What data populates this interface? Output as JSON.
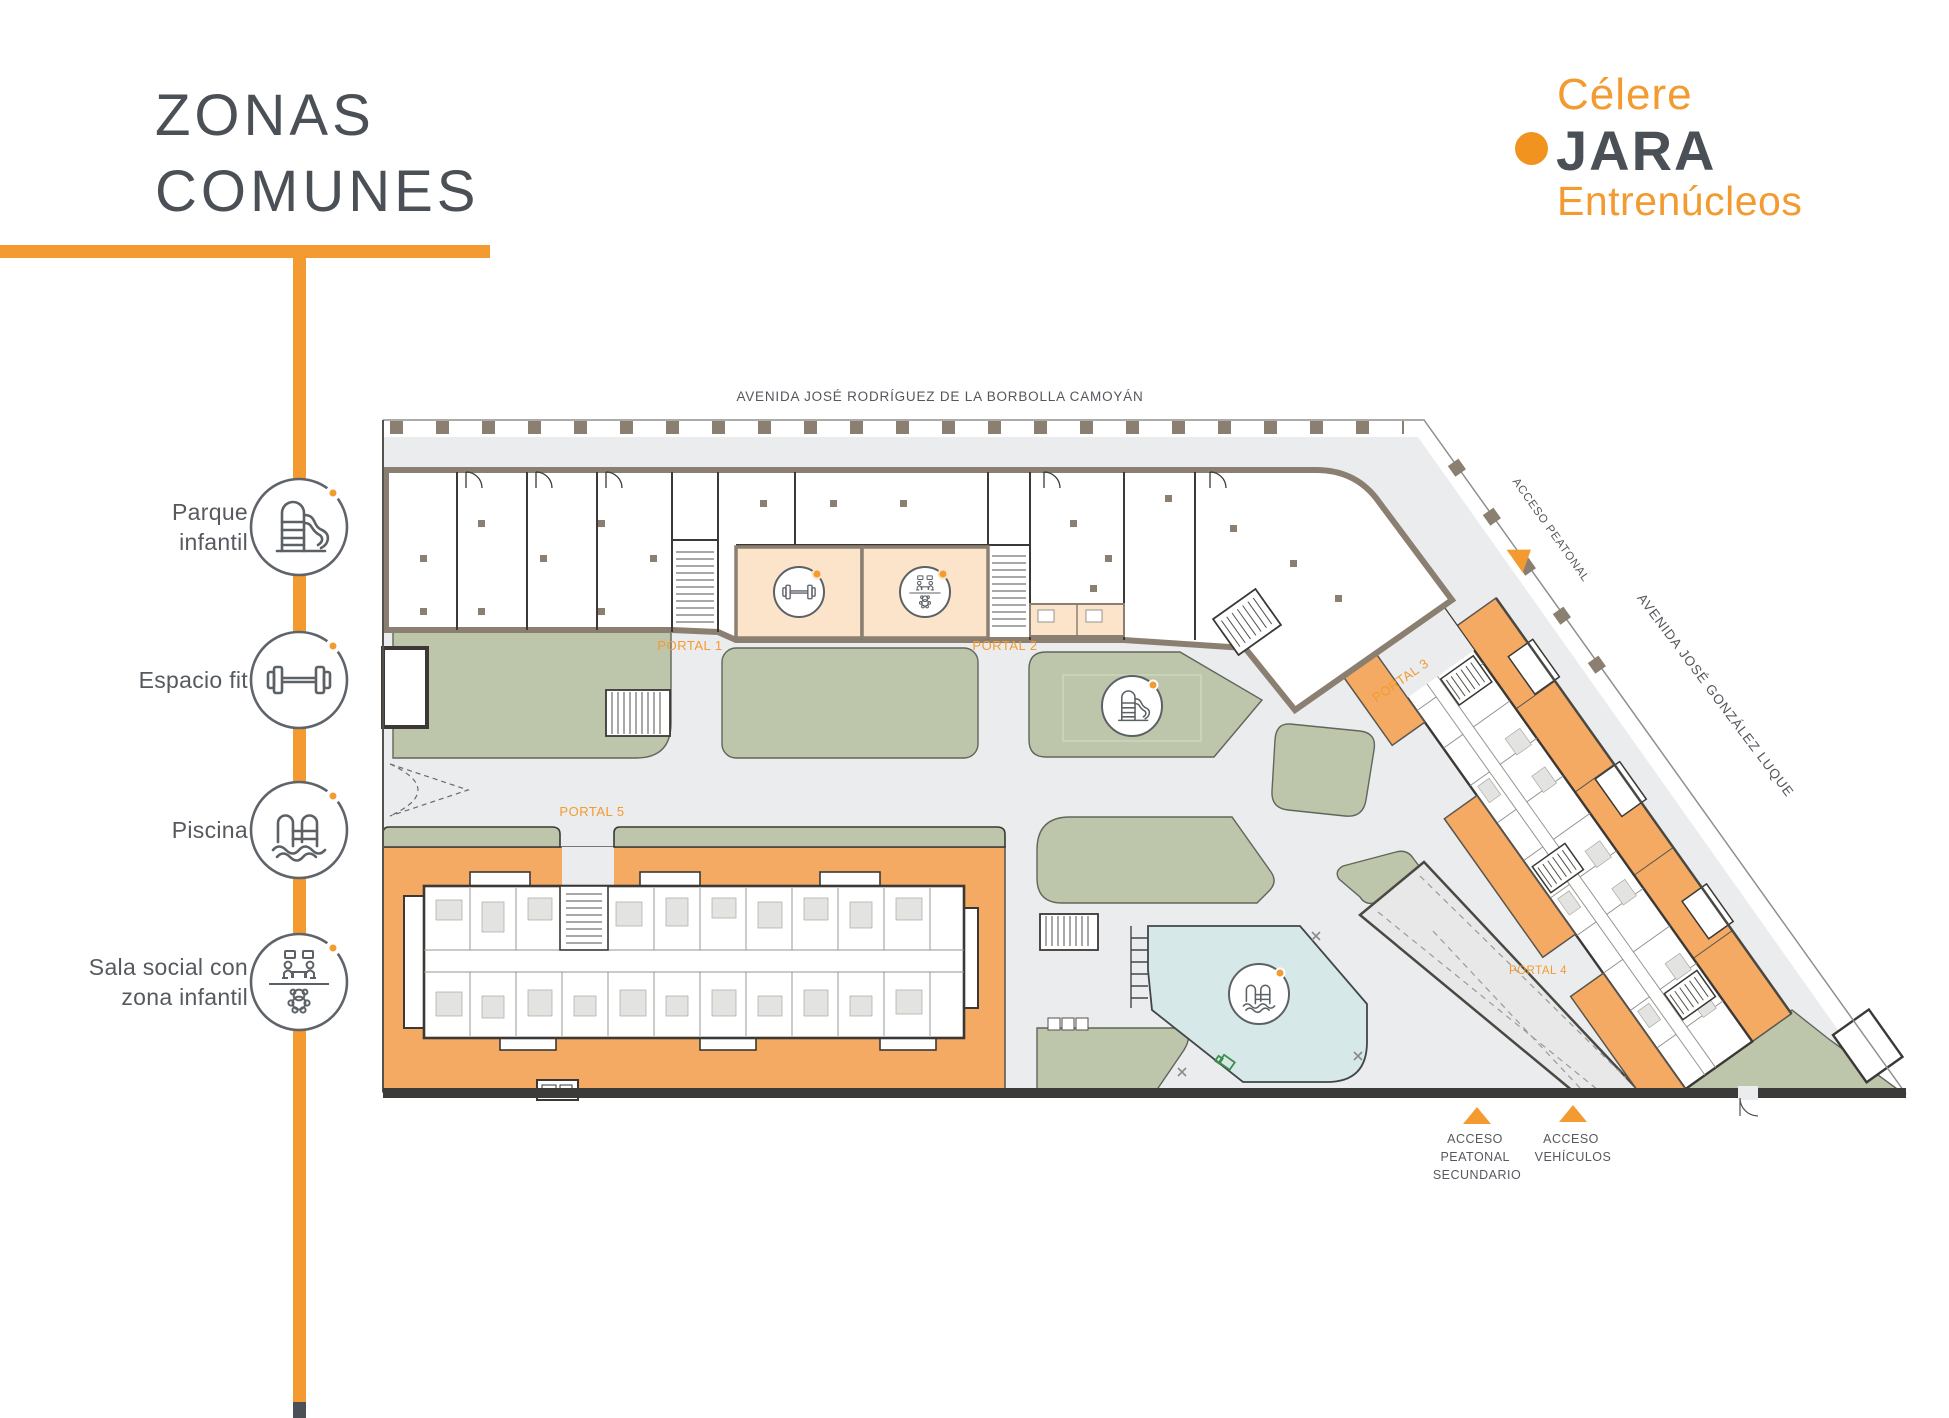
{
  "header": {
    "title_line1": "ZONAS",
    "title_line2": "COMUNES"
  },
  "brand": {
    "name": "Célere",
    "project": "JARA",
    "location": "Entrenúcleos"
  },
  "legend": {
    "items": [
      {
        "line1": "Parque",
        "line2": "infantil",
        "icon": "slide-icon"
      },
      {
        "line1": "Espacio fit",
        "line2": "",
        "icon": "dumbbell-icon"
      },
      {
        "line1": "Piscina",
        "line2": "",
        "icon": "pool-ladder-icon"
      },
      {
        "line1": "Sala social con",
        "line2": "zona infantil",
        "icon": "social-room-icon"
      }
    ]
  },
  "plan": {
    "street_top": "AVENIDA JOSÉ RODRÍGUEZ DE LA BORBOLLA CAMOYÁN",
    "street_right": "AVENIDA JOSÉ GONZÁLEZ LUQUE",
    "portal_1": "PORTAL 1",
    "portal_2": "PORTAL 2",
    "portal_3": "PORTAL 3",
    "portal_4": "PORTAL 4",
    "portal_5": "PORTAL 5",
    "access_pedestrian": "ACCESO PEATONAL",
    "access_secondary": [
      "ACCESO",
      "PEATONAL",
      "SECUNDARIO"
    ],
    "access_vehicles": [
      "ACCESO",
      "VEHÍCULOS"
    ]
  },
  "colors": {
    "accent_orange": "#F39B30",
    "terrace_orange": "#F4AA63",
    "peach": "#FBE4C9",
    "green": "#BDC6AA",
    "pool_blue": "#D7E8E8",
    "ground_gray": "#EBECED",
    "wall_brown": "#8B7F71",
    "text_dark": "#4A5056",
    "label_gray": "#55595E"
  }
}
